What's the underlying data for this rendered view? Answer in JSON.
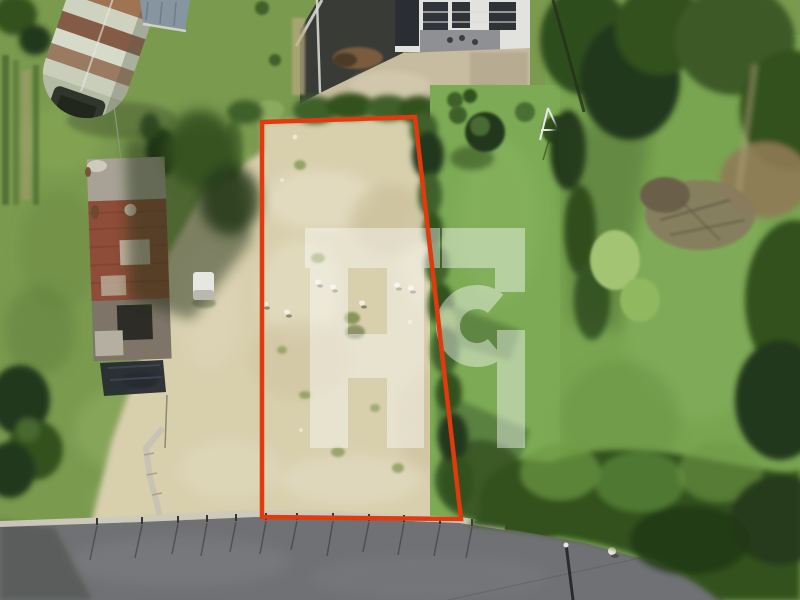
{
  "watermark": {
    "letters": "AG",
    "color": "#ffffff",
    "opacity": 0.42
  },
  "plot_outline": {
    "color": "#e03a0e",
    "stroke_width": 4.5,
    "points_str": "262,122 415,117 461,519 262,517"
  },
  "palette": {
    "grass_base": "#7a9a4e",
    "field": "#d8cfad",
    "lawn": "#7dab55",
    "lawn_right": "#79a450",
    "road": "#707174",
    "curb": "#cdcabf",
    "tree_dark": "#33511f",
    "tree_deep": "#24391a",
    "hedge": "#3f6129",
    "gravel": "#c8bca0",
    "shed_rust": "#8d4d38",
    "hut_pale": "#c9cebb",
    "white": "#ffffff"
  },
  "scene": {
    "features": [
      "quonset-hut",
      "ruined-shed",
      "vacant-plot",
      "boundary-outline",
      "hedgerow",
      "neighbor-garden",
      "house-terrace",
      "lawns",
      "woods",
      "road",
      "curb-stakes",
      "utility-pole",
      "watermark-logo"
    ]
  }
}
